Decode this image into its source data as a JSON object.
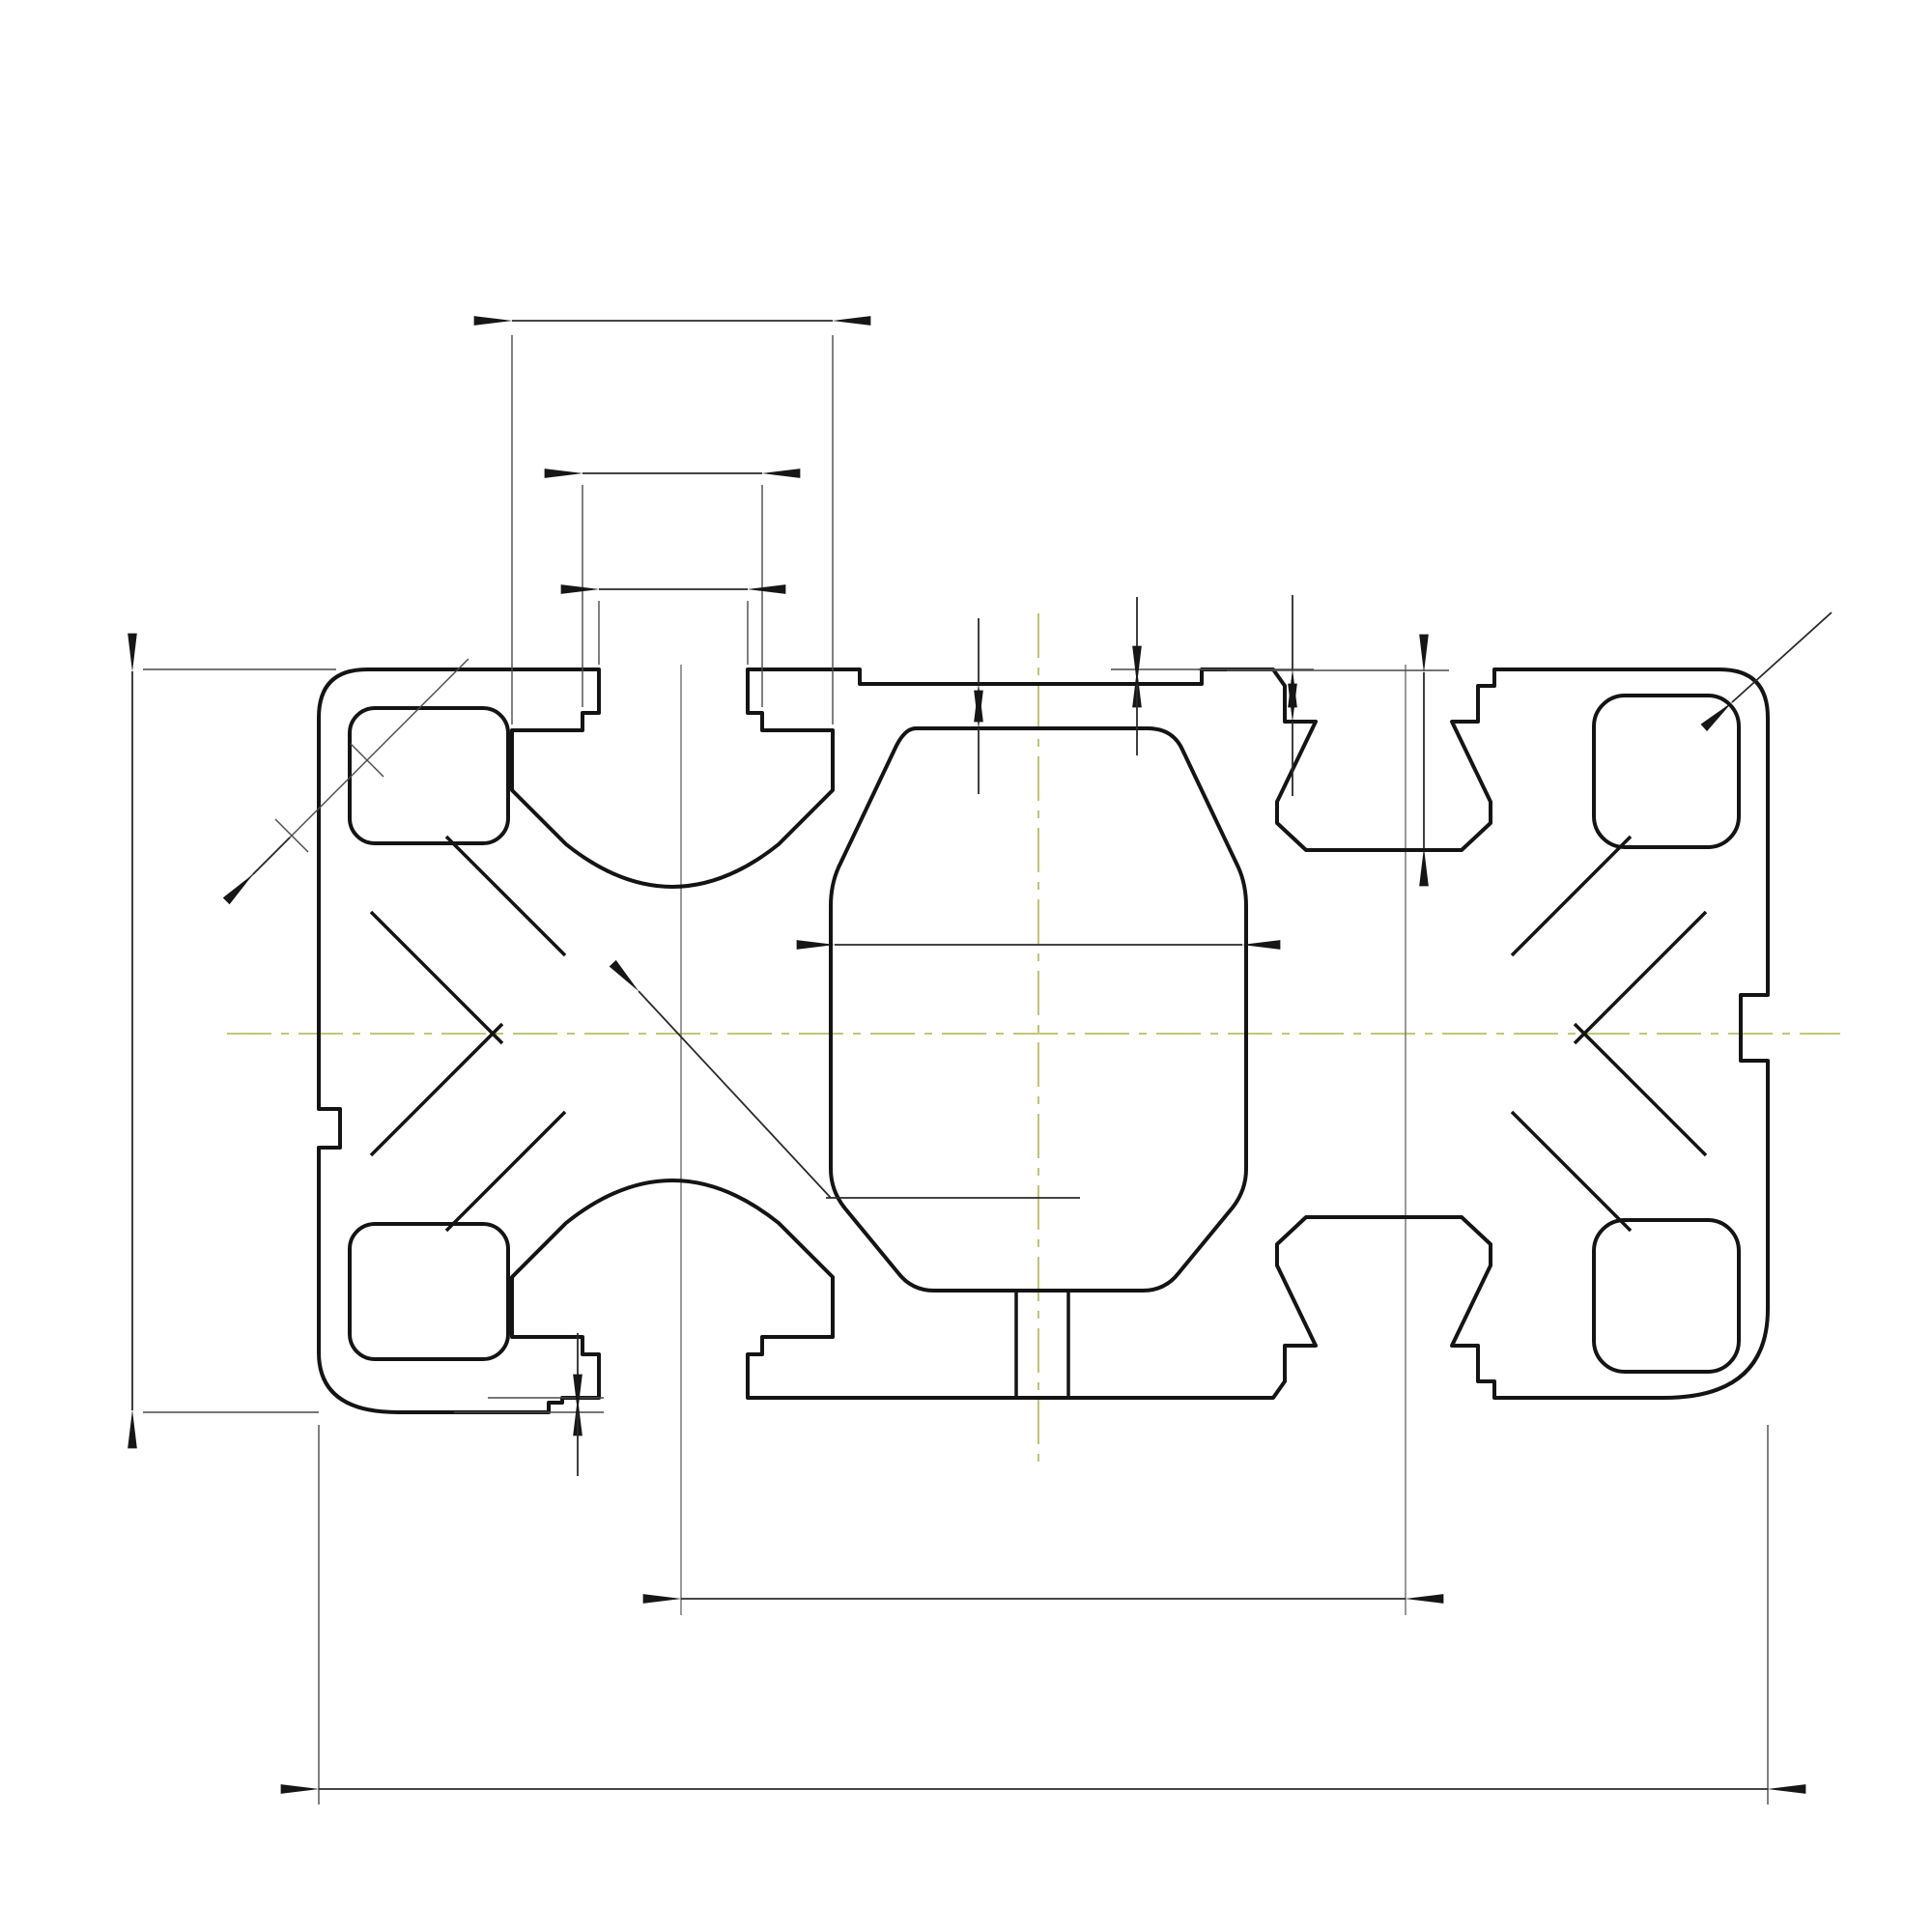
{
  "drawing": {
    "type": "aluminum-extrusion-profile-cross-section",
    "background": "#ffffff",
    "line_color": "#161616",
    "centerline_color": "#b9bf62",
    "profile": {
      "total_width_mm": "100",
      "total_height_mm": "50"
    },
    "dimensions": {
      "slot_outer_width": "22",
      "places_note": "6 мест",
      "slot_mid_width": "12.2",
      "slot_opening": "10.2",
      "wall_thickness": "3",
      "top_step": "1",
      "right_step": "3.5",
      "pocket_depth": "12.5",
      "corner_radius": "R3",
      "profile_height": "50",
      "chamfer_width": "4",
      "channel_width": "8",
      "cavity_width": "29",
      "hole_note_line1": "∅10.2(M12)",
      "hole_note_line2": "2 отв.",
      "foot_step": "1",
      "hole_spacing": "50",
      "total_width": "100"
    },
    "watermark": {
      "brand": "aurelogic",
      "tagline": "research & development",
      "logo_color": "#a6c148",
      "text_color": "#f5f5f5"
    }
  }
}
